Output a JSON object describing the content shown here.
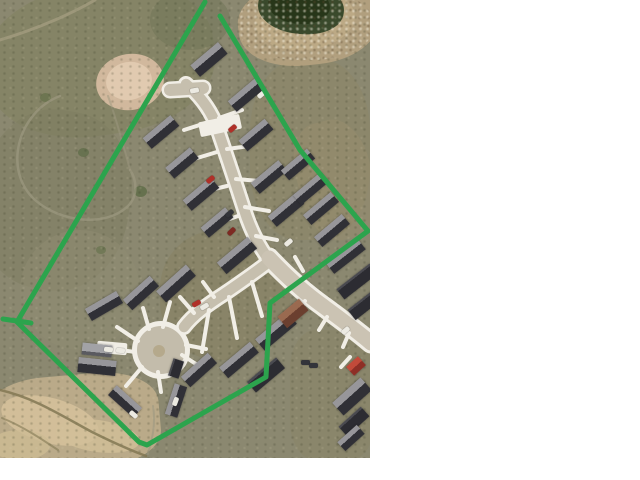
{
  "canvas": {
    "width": 640,
    "height": 480,
    "margin_color": "#ffffff"
  },
  "photo": {
    "x": 0,
    "y": 0,
    "width": 370,
    "height": 458,
    "base_color": "#8b8870",
    "kind": "aerial-photo-of-subdivision"
  },
  "palette": {
    "road": "#c6bfae",
    "collector": "#cbc3b3",
    "sidewalk": "#f1eee6",
    "bulb": "#c3bcab",
    "island": "#b5a98c",
    "house_dark": "#2c2c32",
    "house_mid": "#97969a",
    "trail": "#a39c80",
    "crack": "#827853",
    "boundary_green": "#2ca44d"
  },
  "boundary": {
    "color": "#2ca44d",
    "width": 5,
    "polyline": [
      [
        205,
        2
      ],
      [
        17,
        322
      ],
      [
        139,
        442
      ],
      [
        147,
        445
      ],
      [
        266,
        377
      ],
      [
        270,
        303
      ],
      [
        368,
        231
      ],
      [
        300,
        150
      ],
      [
        220,
        16
      ]
    ],
    "tick": [
      [
        3,
        319
      ],
      [
        31,
        323
      ]
    ]
  },
  "terrain": {
    "patches": [
      {
        "x": -15,
        "y": -15,
        "w": 230,
        "h": 150,
        "r": "45%",
        "c": "#82815f",
        "o": 0.55,
        "rot": -8,
        "n": "scrub-dark"
      },
      {
        "x": -20,
        "y": 110,
        "w": 150,
        "h": 180,
        "r": "45%",
        "c": "#7c7c60",
        "o": 0.45,
        "rot": 10,
        "n": "scrub-dark"
      },
      {
        "x": 150,
        "y": -10,
        "w": 80,
        "h": 60,
        "r": "50%",
        "c": "#6f7356",
        "o": 0.5,
        "rot": 0,
        "n": "scrub-dark"
      },
      {
        "x": 20,
        "y": 230,
        "w": 120,
        "h": 120,
        "r": "50%",
        "c": "#8f8b72",
        "o": 0.5,
        "rot": 0,
        "n": "scrub-light"
      },
      {
        "x": 160,
        "y": 230,
        "w": 130,
        "h": 130,
        "r": "45%",
        "c": "#87805f",
        "o": 0.5,
        "rot": 0,
        "n": "yard-grass"
      },
      {
        "x": 250,
        "y": 60,
        "w": 120,
        "h": 180,
        "r": "40%",
        "c": "#8d8566",
        "o": 0.5,
        "rot": 0,
        "n": "yard-grass"
      },
      {
        "x": 290,
        "y": 330,
        "w": 85,
        "h": 130,
        "r": "30%",
        "c": "#8a8568",
        "o": 0.6,
        "rot": 0,
        "n": "yard-grass"
      },
      {
        "x": 298,
        "y": 120,
        "w": 75,
        "h": 120,
        "r": "40%",
        "c": "#9c8f6d",
        "o": 0.4,
        "rot": -15,
        "n": "bare-dirt"
      },
      {
        "x": 238,
        "y": -20,
        "w": 140,
        "h": 85,
        "r": "45%",
        "c": "#b3a07e",
        "o": 0.95,
        "rot": -6,
        "n": "pond-shore"
      },
      {
        "x": 255,
        "y": -10,
        "w": 100,
        "h": 60,
        "r": "50%",
        "c": "#bfab87",
        "o": 0.8,
        "rot": -6,
        "n": "pond-shore"
      },
      {
        "x": 258,
        "y": -18,
        "w": 86,
        "h": 52,
        "r": "48%",
        "c": "#3a4a2c",
        "o": 1,
        "rot": 6,
        "n": "pond"
      },
      {
        "x": 268,
        "y": -14,
        "w": 62,
        "h": 38,
        "r": "50%",
        "c": "#273619",
        "o": 1,
        "rot": 6,
        "n": "pond"
      },
      {
        "x": 96,
        "y": 54,
        "w": 68,
        "h": 56,
        "r": "50%",
        "c": "#d5baa0",
        "o": 0.95,
        "rot": -10,
        "n": "dirt-patch"
      },
      {
        "x": 106,
        "y": 62,
        "w": 46,
        "h": 38,
        "r": "50%",
        "c": "#e2ccb3",
        "o": 0.9,
        "rot": -10,
        "n": "dirt-patch"
      },
      {
        "x": -15,
        "y": 375,
        "w": 175,
        "h": 95,
        "r": "35%",
        "c": "#bfae8c",
        "o": 0.9,
        "rot": -5,
        "n": "gully-sand"
      },
      {
        "x": 0,
        "y": 398,
        "w": 100,
        "h": 45,
        "r": "50%",
        "c": "#d6c29c",
        "o": 0.85,
        "rot": 15,
        "n": "gully-sand"
      },
      {
        "x": 55,
        "y": 420,
        "w": 85,
        "h": 32,
        "r": "50%",
        "c": "#d2bf98",
        "o": 0.8,
        "rot": 8,
        "n": "gully-sand"
      },
      {
        "x": -10,
        "y": 430,
        "w": 60,
        "h": 30,
        "r": "50%",
        "c": "#cdbb94",
        "o": 0.8,
        "rot": 0,
        "n": "gully-sand"
      },
      {
        "x": 134,
        "y": 186,
        "w": 13,
        "h": 11,
        "r": "50%",
        "c": "#5d6b46",
        "o": 0.8,
        "rot": 0,
        "n": "shrub"
      },
      {
        "x": 78,
        "y": 148,
        "w": 11,
        "h": 9,
        "r": "50%",
        "c": "#5d6b46",
        "o": 0.7,
        "rot": 0,
        "n": "shrub"
      },
      {
        "x": 40,
        "y": 93,
        "w": 11,
        "h": 9,
        "r": "50%",
        "c": "#626f49",
        "o": 0.7,
        "rot": 0,
        "n": "shrub"
      },
      {
        "x": 96,
        "y": 246,
        "w": 10,
        "h": 8,
        "r": "50%",
        "c": "#626f49",
        "o": 0.6,
        "rot": 0,
        "n": "shrub"
      }
    ],
    "shore_speckle": {
      "x": 238,
      "y": -10,
      "w": 135,
      "h": 70
    },
    "trails": [
      {
        "d": "M 95,0 C 75,12 40,28 0,40",
        "w": 3,
        "c": "#a39c80",
        "o": 0.8
      },
      {
        "d": "M 60,96 C 18,112 2,170 35,200 C 60,222 105,228 128,206 C 138,196 137,180 130,170",
        "w": 2.5,
        "c": "#9d9880",
        "o": 0.7
      },
      {
        "d": "M 130,170 C 122,140 115,115 108,96",
        "w": 2,
        "c": "#9d9880",
        "o": 0.5
      },
      {
        "d": "M 148,454 C 152,440 156,424 153,406",
        "w": 2,
        "c": "#9d9880",
        "o": 0.6
      },
      {
        "d": "M 0,390 C 35,398 62,416 92,432 C 112,442 130,450 146,456",
        "w": 2.5,
        "c": "#827853",
        "o": 0.85
      },
      {
        "d": "M 2,418 C 22,426 40,438 58,450",
        "w": 2,
        "c": "#827853",
        "o": 0.6
      }
    ]
  },
  "roads": {
    "color": "#c6bfae",
    "collector_color": "#cbc3b3",
    "sidewalk_color": "#f1eee6",
    "segments": [
      {
        "d": "M 170,90 L 203,88",
        "w": 12,
        "ww": 17,
        "n": "hammerhead"
      },
      {
        "d": "M 186,84 C 198,94 208,106 215,122 C 224,148 232,172 243,206 C 250,229 259,247 270,261",
        "w": 10.5,
        "ww": 16,
        "n": "street-north"
      },
      {
        "d": "M 270,261 C 256,272 240,283 224,294 C 207,305 193,315 184,327",
        "w": 10.5,
        "ww": 16,
        "n": "street-culdesac"
      },
      {
        "d": "M 269,258 C 284,274 302,291 323,306 C 342,320 357,331 371,343",
        "w": 15,
        "ww": 21,
        "n": "collector",
        "collector": true
      }
    ],
    "bulb": {
      "cx": 161,
      "cy": 350,
      "r": 24,
      "wr": 29,
      "island_r": 6,
      "island_cx": 159,
      "island_cy": 351
    },
    "driveway_w": 4,
    "driveways": [
      [
        219,
        118,
        242,
        110
      ],
      [
        227,
        149,
        250,
        146
      ],
      [
        236,
        179,
        259,
        181
      ],
      [
        245,
        207,
        269,
        211
      ],
      [
        256,
        236,
        277,
        240
      ],
      [
        209,
        122,
        184,
        130
      ],
      [
        217,
        152,
        194,
        159
      ],
      [
        227,
        186,
        206,
        191
      ],
      [
        238,
        216,
        221,
        222
      ],
      [
        229,
        297,
        237,
        338
      ],
      [
        209,
        310,
        202,
        352
      ],
      [
        252,
        282,
        262,
        316
      ],
      [
        214,
        297,
        203,
        282
      ],
      [
        194,
        313,
        180,
        297
      ],
      [
        149,
        329,
        143,
        308
      ],
      [
        163,
        327,
        170,
        302
      ],
      [
        138,
        341,
        117,
        327
      ],
      [
        135,
        352,
        107,
        348
      ],
      [
        142,
        367,
        126,
        386
      ],
      [
        158,
        372,
        161,
        392
      ],
      [
        182,
        355,
        196,
        364
      ],
      [
        186,
        345,
        206,
        349
      ],
      [
        305,
        301,
        297,
        313
      ],
      [
        327,
        317,
        319,
        330
      ],
      [
        349,
        333,
        343,
        347
      ],
      [
        295,
        257,
        303,
        271
      ],
      [
        350,
        357,
        341,
        367
      ]
    ]
  },
  "pads": [
    {
      "x": 220,
      "y": 125,
      "l": 42,
      "w": 15,
      "rot": -12
    },
    {
      "x": 112,
      "y": 348,
      "l": 30,
      "w": 12,
      "rot": 5
    },
    {
      "x": 345,
      "y": 404,
      "l": 14,
      "w": 9,
      "rot": -40
    }
  ],
  "houses": {
    "styles": {
      "d2": "linear-gradient(to bottom,#97969a 0 42%,#303036 42% 100%)",
      "d": "linear-gradient(to bottom,#4a4a50 0 18%,#2c2c32 18% 100%)",
      "light": "linear-gradient(to bottom,#a2a2a6 0 70%,#5a5a60 70% 100%)",
      "brown": "linear-gradient(to bottom,#9a6a50 0 45%,#6b3f2f 45% 100%)",
      "red": "linear-gradient(to bottom,#c24a3a 0 50%,#8e2f26 50% 100%)"
    },
    "list": [
      [
        209,
        59,
        36,
        15,
        -40,
        "d2"
      ],
      [
        246,
        95,
        36,
        14,
        -40,
        "d2"
      ],
      [
        256,
        135,
        34,
        14,
        -40,
        "d2"
      ],
      [
        269,
        177,
        36,
        14,
        -40,
        "d2"
      ],
      [
        286,
        210,
        36,
        14,
        -40,
        "d2"
      ],
      [
        298,
        164,
        34,
        13,
        -40,
        "d2"
      ],
      [
        311,
        188,
        36,
        13,
        -40,
        "d2"
      ],
      [
        321,
        208,
        36,
        13,
        -40,
        "d2"
      ],
      [
        332,
        230,
        36,
        13,
        -40,
        "d2"
      ],
      [
        346,
        256,
        40,
        13,
        -38,
        "d2"
      ],
      [
        357,
        281,
        42,
        13,
        -38,
        "d"
      ],
      [
        365,
        304,
        34,
        13,
        -38,
        "d"
      ],
      [
        161,
        132,
        36,
        14,
        -40,
        "d2"
      ],
      [
        182,
        163,
        32,
        14,
        -40,
        "d2"
      ],
      [
        201,
        194,
        36,
        14,
        -40,
        "d2"
      ],
      [
        217,
        222,
        32,
        13,
        -40,
        "d2"
      ],
      [
        141,
        293,
        36,
        14,
        -42,
        "d2"
      ],
      [
        176,
        283,
        40,
        15,
        -42,
        "d2"
      ],
      [
        237,
        255,
        40,
        15,
        -40,
        "d2"
      ],
      [
        104,
        306,
        36,
        14,
        -30,
        "d2"
      ],
      [
        97,
        350,
        30,
        12,
        6,
        "light"
      ],
      [
        97,
        366,
        38,
        15,
        6,
        "d2"
      ],
      [
        125,
        401,
        34,
        13,
        42,
        "d2"
      ],
      [
        176,
        400,
        32,
        13,
        -72,
        "d2"
      ],
      [
        176,
        368,
        18,
        11,
        -72,
        "d"
      ],
      [
        199,
        370,
        36,
        14,
        -42,
        "d2"
      ],
      [
        239,
        360,
        40,
        14,
        -40,
        "d2"
      ],
      [
        276,
        331,
        42,
        15,
        -40,
        "d2"
      ],
      [
        266,
        375,
        38,
        14,
        -40,
        "d"
      ],
      [
        293,
        313,
        28,
        15,
        -40,
        "brown"
      ],
      [
        356,
        366,
        16,
        12,
        -42,
        "red"
      ],
      [
        352,
        396,
        38,
        17,
        -42,
        "d2"
      ],
      [
        354,
        421,
        30,
        13,
        -42,
        "d"
      ],
      [
        351,
        438,
        26,
        12,
        -42,
        "d2"
      ]
    ]
  },
  "cars": {
    "colors": {
      "red": "#b03028",
      "darkred": "#7e2a22",
      "white": "#eceae2",
      "dark": "#33343a"
    },
    "size": [
      9,
      5
    ],
    "list": [
      [
        210,
        179,
        -40,
        "red"
      ],
      [
        231,
        231,
        -45,
        "darkred"
      ],
      [
        196,
        303,
        -30,
        "red"
      ],
      [
        204,
        306,
        -30,
        "white"
      ],
      [
        232,
        128,
        -40,
        "red"
      ],
      [
        194,
        90,
        -10,
        "white"
      ],
      [
        261,
        94,
        -40,
        "white"
      ],
      [
        288,
        242,
        -40,
        "white"
      ],
      [
        108,
        349,
        5,
        "white"
      ],
      [
        120,
        350,
        5,
        "white"
      ],
      [
        175,
        401,
        -70,
        "white"
      ],
      [
        345,
        330,
        -40,
        "white"
      ],
      [
        133,
        414,
        40,
        "white"
      ],
      [
        305,
        362,
        0,
        "dark"
      ],
      [
        313,
        365,
        0,
        "dark"
      ],
      [
        229,
        213,
        -40,
        "dark"
      ]
    ]
  }
}
